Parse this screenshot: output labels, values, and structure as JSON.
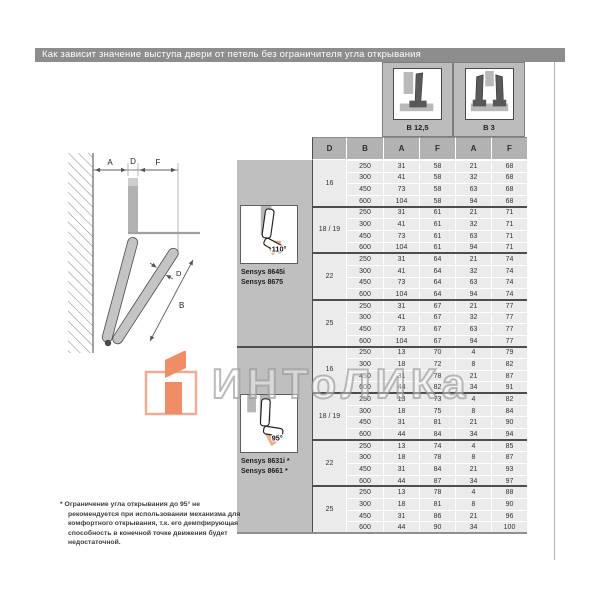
{
  "page": {
    "title": "Как зависит значение выступа двери от петель без ограничителя угла открывания"
  },
  "legend": [
    {
      "label": "B 12,5",
      "icon": "single-overlay-door-icon"
    },
    {
      "label": "B 3",
      "icon": "double-overlay-door-icon"
    }
  ],
  "diagram": {
    "labels": {
      "a": "A",
      "d_top": "D",
      "f": "F",
      "d_door": "D",
      "b": "B"
    }
  },
  "table": {
    "columns": [
      "D",
      "B",
      "A",
      "F",
      "A",
      "F"
    ],
    "sections": [
      {
        "angle": "110°",
        "models": [
          "Sensys 8645i",
          "Sensys 8675"
        ],
        "groups": [
          {
            "d": "16",
            "rows": [
              [
                250,
                31,
                58,
                21,
                68
              ],
              [
                300,
                41,
                58,
                32,
                68
              ],
              [
                450,
                73,
                58,
                63,
                68
              ],
              [
                600,
                104,
                58,
                94,
                68
              ]
            ]
          },
          {
            "d": "18 / 19",
            "rows": [
              [
                250,
                31,
                61,
                21,
                71
              ],
              [
                300,
                41,
                61,
                32,
                71
              ],
              [
                450,
                73,
                61,
                63,
                71
              ],
              [
                600,
                104,
                61,
                94,
                71
              ]
            ]
          },
          {
            "d": "22",
            "rows": [
              [
                250,
                31,
                64,
                21,
                74
              ],
              [
                300,
                41,
                64,
                32,
                74
              ],
              [
                450,
                73,
                64,
                63,
                74
              ],
              [
                600,
                104,
                64,
                94,
                74
              ]
            ]
          },
          {
            "d": "25",
            "rows": [
              [
                250,
                31,
                67,
                21,
                77
              ],
              [
                300,
                41,
                67,
                32,
                77
              ],
              [
                450,
                73,
                67,
                63,
                77
              ],
              [
                600,
                104,
                67,
                94,
                77
              ]
            ]
          }
        ]
      },
      {
        "angle": "95°",
        "models": [
          "Sensys 8631i *",
          "Sensys 8661 *"
        ],
        "groups": [
          {
            "d": "16",
            "rows": [
              [
                250,
                13,
                70,
                4,
                79
              ],
              [
                300,
                18,
                72,
                8,
                82
              ],
              [
                450,
                31,
                78,
                21,
                87
              ],
              [
                600,
                44,
                82,
                34,
                91
              ]
            ]
          },
          {
            "d": "18 / 19",
            "rows": [
              [
                250,
                13,
                73,
                4,
                82
              ],
              [
                300,
                18,
                75,
                8,
                84
              ],
              [
                450,
                31,
                81,
                21,
                90
              ],
              [
                600,
                44,
                84,
                34,
                94
              ]
            ]
          },
          {
            "d": "22",
            "rows": [
              [
                250,
                13,
                74,
                4,
                85
              ],
              [
                300,
                18,
                78,
                8,
                87
              ],
              [
                450,
                31,
                84,
                21,
                93
              ],
              [
                600,
                44,
                87,
                34,
                97
              ]
            ]
          },
          {
            "d": "25",
            "rows": [
              [
                250,
                13,
                78,
                4,
                88
              ],
              [
                300,
                18,
                81,
                8,
                90
              ],
              [
                450,
                31,
                86,
                21,
                96
              ],
              [
                600,
                44,
                90,
                34,
                100
              ]
            ]
          }
        ]
      }
    ]
  },
  "watermark": {
    "text": "ИНТоЛИКа"
  },
  "footnote": "* Ограничение угла открывания до 95° не рекомендуется при использовании механизма для комфортного открывания, т.к. его демпфирующая способность в конечной точке движения будет недостаточной.",
  "colors": {
    "title_bar": "#8d8d8d",
    "header_cell": "#b2b2b2",
    "data_cell": "#ebebeb",
    "sidebar": "#bfbfbf",
    "separator": "#4d4d4d",
    "accent_orange": "#ee8156",
    "accent_orange_light": "#f2a488"
  }
}
